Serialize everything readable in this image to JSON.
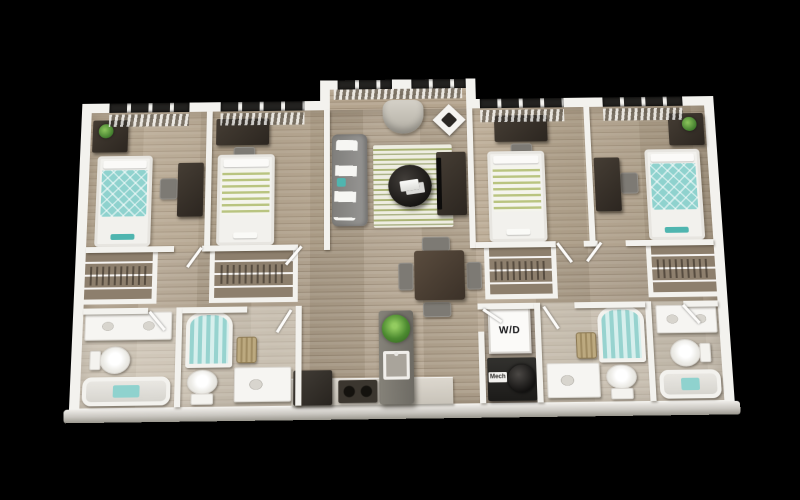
{
  "image": {
    "alt": "3D rendered top-down floor plan of a four-bedroom, four-bathroom apartment with central living room and kitchen, on a black background"
  },
  "labels": {
    "washer_dryer": "W/D",
    "mechanical": "Mech"
  },
  "rooms": [
    "bedroom-1",
    "bedroom-2",
    "bedroom-3",
    "bedroom-4",
    "living-room",
    "dining-area",
    "kitchen",
    "laundry-closet",
    "bathroom-1",
    "bathroom-2",
    "bathroom-3",
    "bathroom-4",
    "closet-1",
    "closet-2",
    "closet-3",
    "closet-4"
  ],
  "palette": {
    "bg": "#000000",
    "wall": "#f3f2ee",
    "wood": "#b4a48e",
    "wood-dark": "#a2927d",
    "teal": "#8fd2ce",
    "teal-deep": "#4fb5af",
    "stripe-green": "#b9c480",
    "furn-dark": "#342e28",
    "sofa": "#8e8d8a",
    "counter": "#d8d3ca",
    "island": "#7a776f",
    "plant": "#4c8a30",
    "window": "#232220",
    "rug": "#eeede1",
    "appliance": "#28241f"
  }
}
